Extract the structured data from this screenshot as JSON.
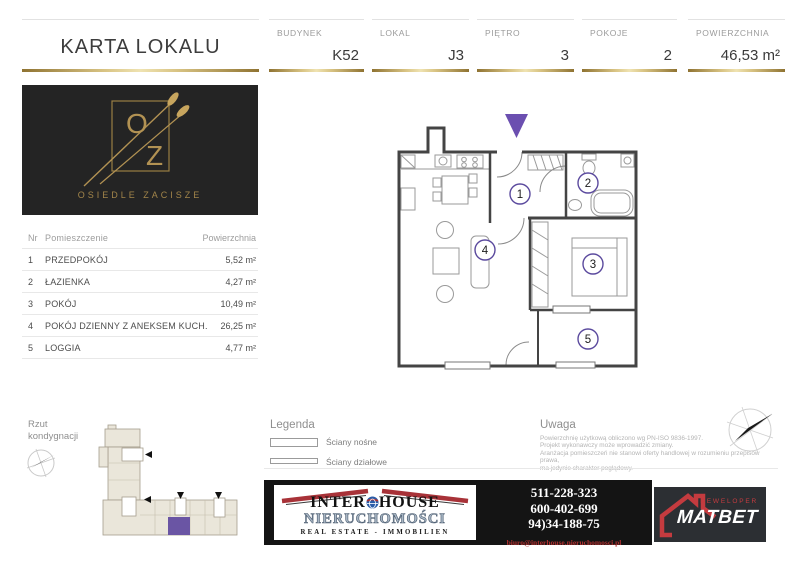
{
  "header": {
    "title": "KARTA LOKALU",
    "fields": [
      {
        "label": "BUDYNEK",
        "value": "K52"
      },
      {
        "label": "LOKAL",
        "value": "J3"
      },
      {
        "label": "PIĘTRO",
        "value": "3"
      },
      {
        "label": "POKOJE",
        "value": "2"
      },
      {
        "label": "POWIERZCHNIA",
        "value": "46,53 m²"
      }
    ]
  },
  "estate_logo": {
    "letter_o": "O",
    "letter_z": "Z",
    "name": "OSIEDLE ZACISZE",
    "gold_color": "#b29253"
  },
  "rooms_table": {
    "columns": {
      "nr": "Nr",
      "name": "Pomieszczenie",
      "area": "Powierzchnia"
    },
    "rows": [
      {
        "nr": "1",
        "name": "PRZEDPOKÓJ",
        "area": "5,52 m²"
      },
      {
        "nr": "2",
        "name": "ŁAZIENKA",
        "area": "4,27 m²"
      },
      {
        "nr": "3",
        "name": "POKÓJ",
        "area": "10,49 m²"
      },
      {
        "nr": "4",
        "name": "POKÓJ DZIENNY Z ANEKSEM KUCH.",
        "area": "26,25 m²"
      },
      {
        "nr": "5",
        "name": "LOGGIA",
        "area": "4,77 m²"
      }
    ]
  },
  "floor_plan": {
    "room_numbers": [
      "1",
      "2",
      "3",
      "4",
      "5"
    ],
    "entrance_marker_color": "#6b4fb0",
    "room_circle_color": "#5b4a9e"
  },
  "level_plan": {
    "label_line1": "Rzut",
    "label_line2": "kondygnacji",
    "highlight_color": "#6a55a4"
  },
  "legend": {
    "title": "Legenda",
    "items": [
      {
        "label": "Ściany nośne"
      },
      {
        "label": "Ściany działowe"
      }
    ]
  },
  "note": {
    "title": "Uwaga",
    "lines": [
      "Powierzchnię użytkową obliczono wg PN-ISO 9836-1997.",
      "Projekt wykonawczy może wprowadzić zmiany.",
      "Aranżacja pomieszczeń nie stanowi oferty handlowej w rozumieniu przepisów prawa,",
      "ma jedynie charakter poglądowy."
    ]
  },
  "agency": {
    "name_left": "INTER",
    "name_right": "HOUSE",
    "name_mid": "NIERUCHOMOŚCI",
    "name_bottom": "REAL ESTATE - IMMOBILIEN",
    "phones": [
      "511-228-323",
      "600-402-699",
      "94)34-188-75"
    ],
    "email": "biuro@interhouse.nieruchomosci.pl"
  },
  "developer": {
    "name": "MATBET",
    "tagline": "DEWELOPER",
    "accent_color": "#c43b3f"
  }
}
